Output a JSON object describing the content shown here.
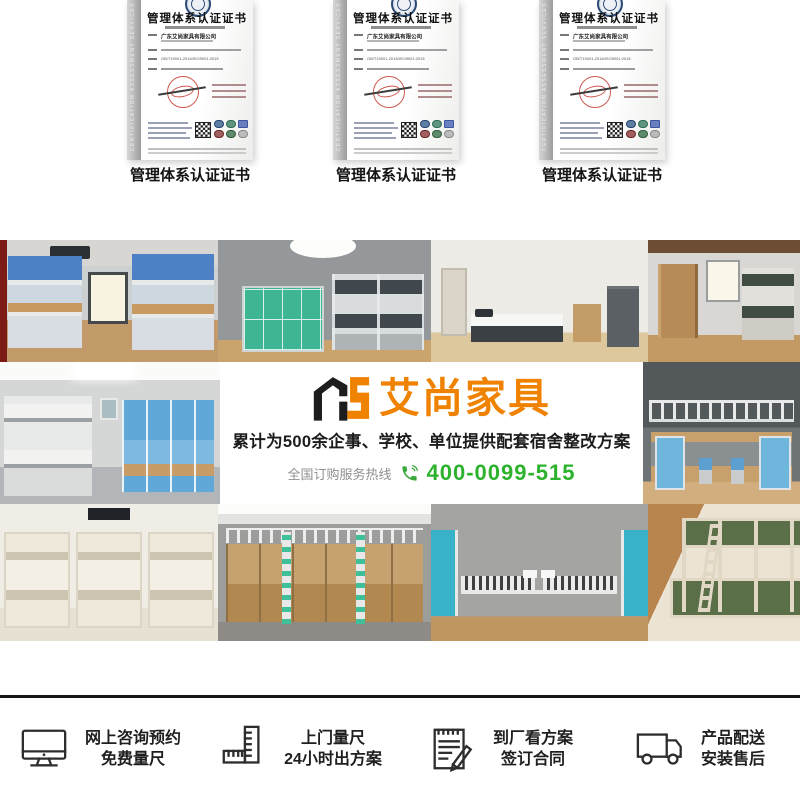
{
  "certificates": {
    "title": "管理体系认证证书",
    "company": "广东艾尚家具有限公司",
    "standard": "GB/T19001-2016/ISO9001:2015",
    "side_text": "CERTIFICATION ASSESSMENT SERVICES",
    "items": [
      {
        "caption": "管理体系认证证书"
      },
      {
        "caption": "管理体系认证证书"
      },
      {
        "caption": "管理体系认证证书"
      }
    ]
  },
  "banner": {
    "logo_mark": "AS",
    "logo_text": "艾尚家具",
    "tagline": "累计为500余企事、学校、单位提供配套宿舍整改方案",
    "hotline_label": "全国订购服务热线",
    "phone_icon": "phone-icon",
    "phone_number": "400-0099-515",
    "colors": {
      "orange": "#ef8200",
      "green": "#2cb22c",
      "text": "#1c1c1c"
    }
  },
  "gallery": {
    "photos": [
      "dorm-blue-bunk-desk-room",
      "locker-and-bunk-room",
      "single-bed-study-room",
      "wardrobe-bunk-room",
      "grey-bunk-blue-wardrobe-room",
      "loft-bed-desk-room",
      "triple-bunk-room",
      "loft-desk-wardrobe-room",
      "twin-beds-blue-wardrobe-room",
      "green-steel-bunk-room"
    ]
  },
  "services": [
    {
      "icon": "monitor-icon",
      "line1": "网上咨询预约",
      "line2": "免费量尺"
    },
    {
      "icon": "ruler-icon",
      "line1": "上门量尺",
      "line2": "24小时出方案"
    },
    {
      "icon": "contract-icon",
      "line1": "到厂看方案",
      "line2": "签订合同"
    },
    {
      "icon": "truck-icon",
      "line1": "产品配送",
      "line2": "安装售后"
    }
  ]
}
